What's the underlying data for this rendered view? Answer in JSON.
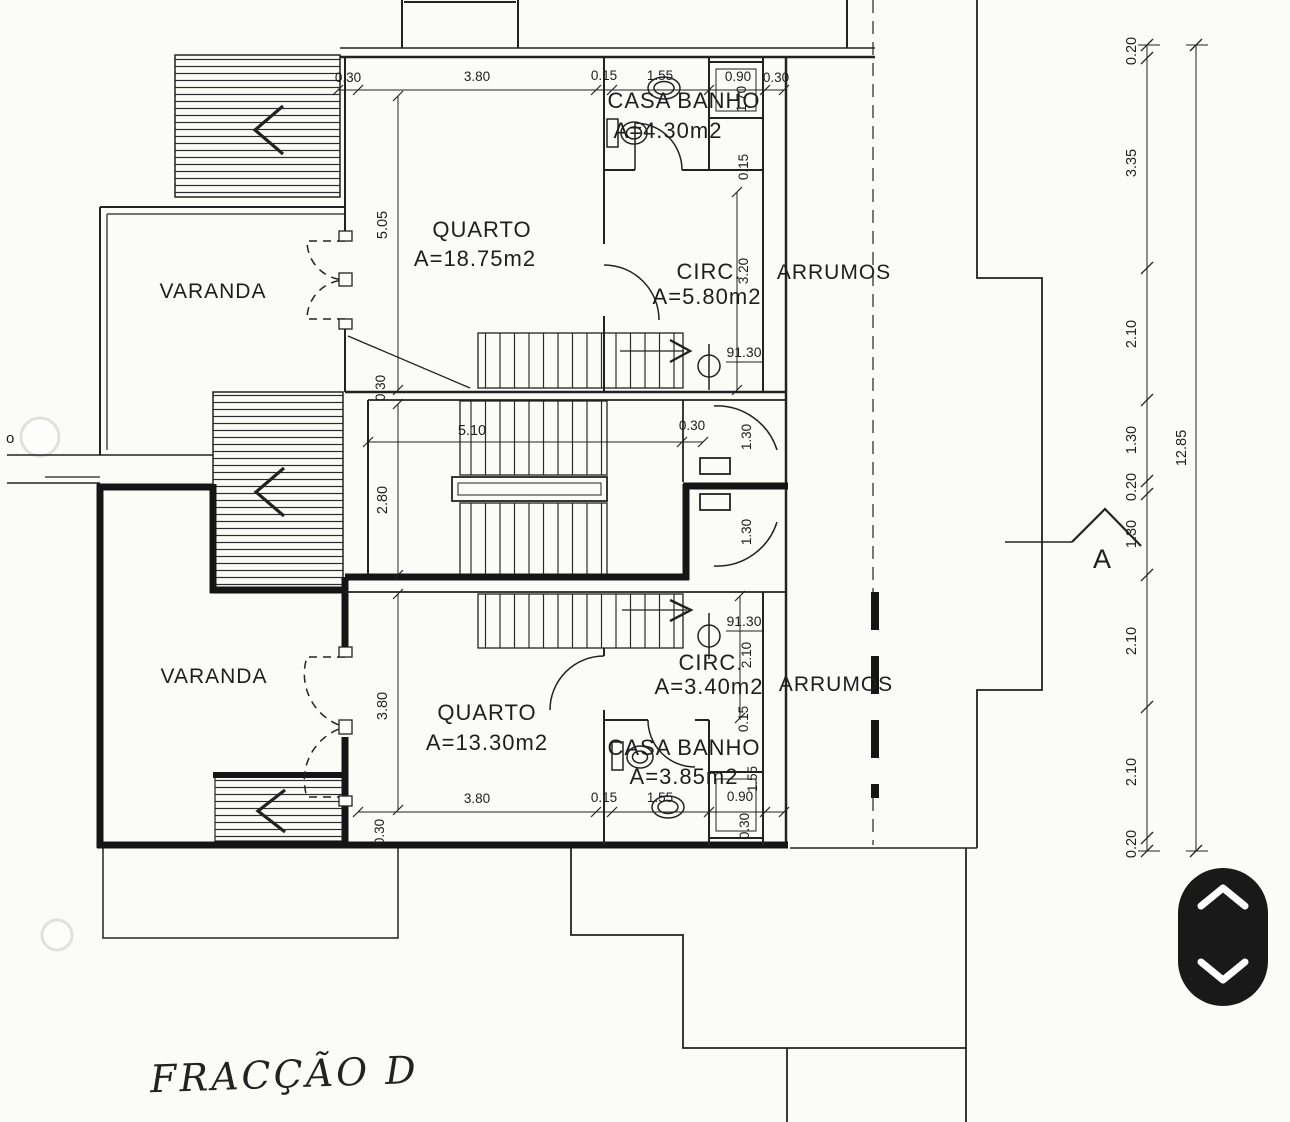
{
  "title_annotation": "FRACÇÃO D",
  "margin_mark": "o",
  "section_marker": "A",
  "levels": {
    "upper": "91.30",
    "lower": "91.30"
  },
  "rooms": {
    "varanda_upper": {
      "name": "VARANDA"
    },
    "quarto_upper": {
      "name": "QUARTO",
      "area": "A=18.75m2"
    },
    "casa_banho_upper": {
      "name": "CASA BANHO",
      "area": "A=4.30m2"
    },
    "circ_upper": {
      "name": "CIRC.",
      "area": "A=5.80m2"
    },
    "arrumos_upper": {
      "name": "ARRUMOS"
    },
    "varanda_lower": {
      "name": "VARANDA"
    },
    "quarto_lower": {
      "name": "QUARTO",
      "area": "A=13.30m2"
    },
    "casa_banho_lower": {
      "name": "CASA BANHO",
      "area": "A=3.85m2"
    },
    "circ_lower": {
      "name": "CIRC.",
      "area": "A=3.40m2"
    },
    "arrumos_lower": {
      "name": "ARRUMOS"
    }
  },
  "dims": {
    "top": [
      "0.30",
      "3.80",
      "0.15",
      "1.55",
      "0.90",
      "0.30"
    ],
    "bottom": [
      "3.80",
      "0.15",
      "1.55",
      "0.90"
    ],
    "stair": {
      "width": "5.10",
      "wall": "0.30",
      "mid_height": "2.80",
      "upper_wall": "0.30"
    },
    "quarto_upper_height": "5.05",
    "quarto_lower_height": "3.80",
    "shaft_upper": {
      "h": "1.70",
      "wall": "0.15"
    },
    "shaft_lower": {
      "wall": "0.15",
      "h": "1.55",
      "bottom_wall": "0.30"
    },
    "circ_upper_height": "3.20",
    "circ_lower_height": "2.10",
    "door_upper": "1.30",
    "door_lower": "1.30",
    "bottom_wall": "0.30"
  },
  "dim_chain": {
    "segments": [
      "0.20",
      "3.35",
      "2.10",
      "1.30",
      "0.20",
      "1.30",
      "2.10",
      "2.10",
      "0.20"
    ],
    "total": "12.85"
  },
  "icons": {
    "up": "chevron-up-icon",
    "down": "chevron-down-icon"
  },
  "colors": {
    "paper": "#fbfbf8",
    "ink": "#1e1e1e",
    "widget": "#191919"
  }
}
